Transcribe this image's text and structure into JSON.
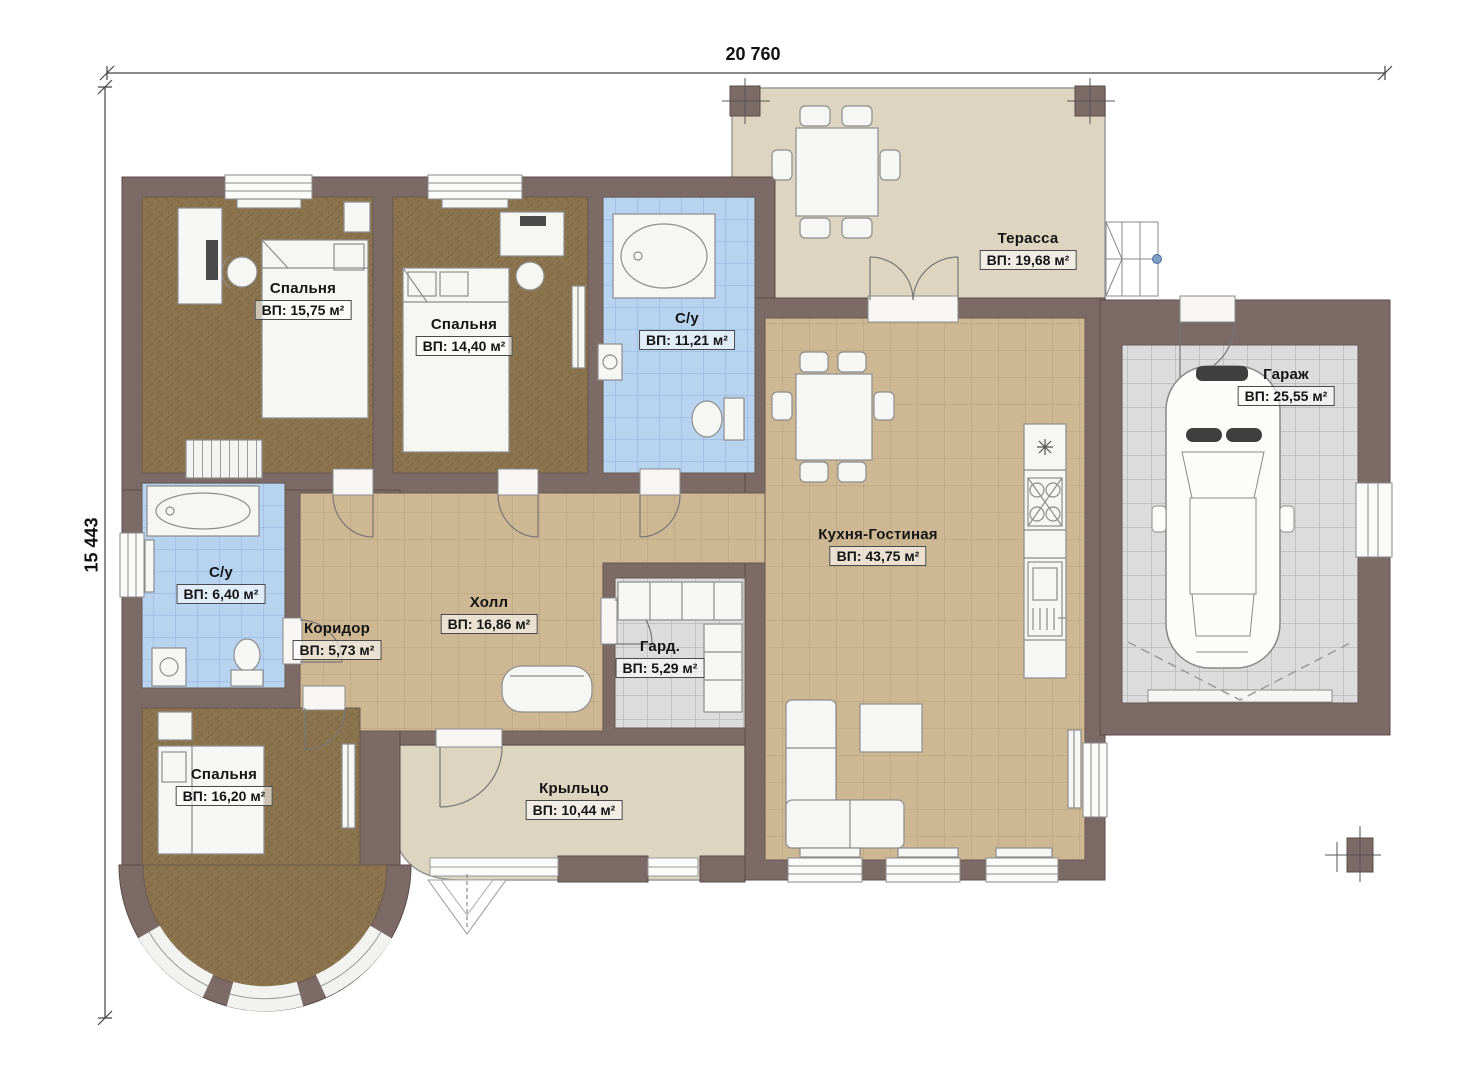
{
  "dimensions": {
    "top": "20 760",
    "left": "15 443"
  },
  "rooms": [
    {
      "id": "bedroom-1",
      "name": "Спальня",
      "area": "ВП: 15,75 м²"
    },
    {
      "id": "bedroom-2",
      "name": "Спальня",
      "area": "ВП: 14,40 м²"
    },
    {
      "id": "bathroom-1",
      "name": "С/у",
      "area": "ВП: 11,21 м²"
    },
    {
      "id": "terrace",
      "name": "Терасса",
      "area": "ВП: 19,68 м²"
    },
    {
      "id": "garage",
      "name": "Гараж",
      "area": "ВП: 25,55 м²"
    },
    {
      "id": "kitchen-living",
      "name": "Кухня-Гостиная",
      "area": "ВП: 43,75 м²"
    },
    {
      "id": "bathroom-2",
      "name": "С/у",
      "area": "ВП: 6,40 м²"
    },
    {
      "id": "corridor",
      "name": "Коридор",
      "area": "ВП: 5,73 м²"
    },
    {
      "id": "hall",
      "name": "Холл",
      "area": "ВП: 16,86 м²"
    },
    {
      "id": "wardrobe",
      "name": "Гард.",
      "area": "ВП: 5,29 м²"
    },
    {
      "id": "bedroom-3",
      "name": "Спальня",
      "area": "ВП: 16,20 м²"
    },
    {
      "id": "porch",
      "name": "Крыльцо",
      "area": "ВП: 10,44 м²"
    }
  ],
  "colors": {
    "wall": "#7c6a66",
    "carpet": "#8b744e",
    "tile_tan": "#cdb893",
    "tile_blue": "#b7d3ef",
    "tile_gray": "#dcdcdc",
    "terrace_floor": "#ded5c1",
    "furniture": "#f6f6f4"
  }
}
